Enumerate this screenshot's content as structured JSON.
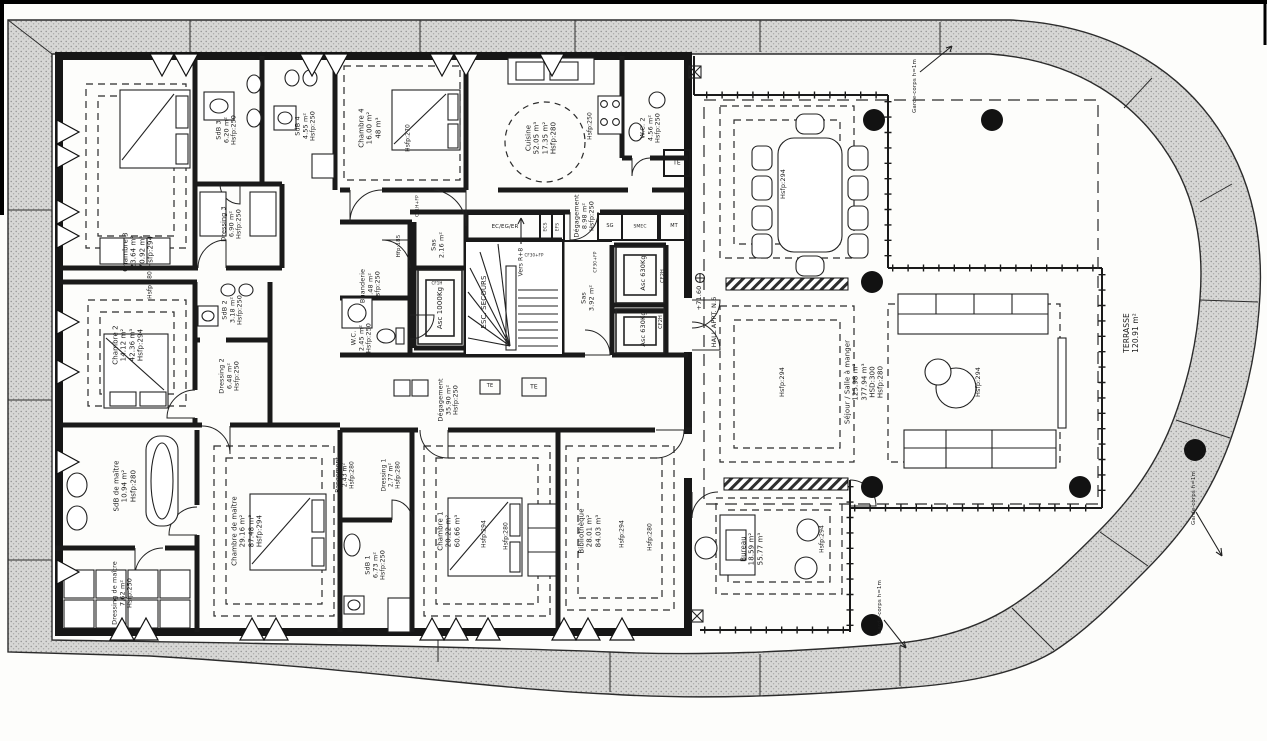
{
  "plan": {
    "apartment": "HALL APPT. N.6",
    "level_marker": "+71.60",
    "terrace": {
      "name": "TERRASSE",
      "area": "120.91 m²"
    },
    "guardrail_note": "Garde-corps h=1m",
    "labels": [
      {
        "name": "room-chambre-3",
        "x": 138,
        "y": 252,
        "size": 7,
        "lines": [
          "Chambre 3",
          "23.64 m²",
          "70.92 m³",
          "Hsfp:294"
        ]
      },
      {
        "name": "room-sdb-3",
        "x": 227,
        "y": 130,
        "size": 6.5,
        "lines": [
          "SdB 3",
          "6.20 m²",
          "Hsfp:250"
        ]
      },
      {
        "name": "room-sdb-4",
        "x": 306,
        "y": 126,
        "size": 6.5,
        "lines": [
          "SdB 4",
          "4.55 m²",
          "Hsfp:250"
        ]
      },
      {
        "name": "room-dressing-3",
        "x": 232,
        "y": 224,
        "size": 6.5,
        "lines": [
          "Dressing 3",
          "6.90 m²",
          "Hsfp:250"
        ]
      },
      {
        "name": "room-chambre-4",
        "x": 370,
        "y": 128,
        "size": 7,
        "lines": [
          "Chambre 4",
          "16.00 m²",
          "48 m³"
        ]
      },
      {
        "name": "height-tag",
        "x": 408,
        "y": 138,
        "size": 6,
        "lines": [
          "Hsfp:270"
        ]
      },
      {
        "name": "height-tag",
        "x": 399,
        "y": 246,
        "size": 5.5,
        "lines": [
          "Hfp:185"
        ]
      },
      {
        "name": "room-cuisine",
        "x": 541,
        "y": 138,
        "size": 7,
        "lines": [
          "Cuisine",
          "52.05 m³",
          "17.35 m²",
          "Hsfp:280"
        ]
      },
      {
        "name": "height-tag",
        "x": 590,
        "y": 126,
        "size": 6,
        "lines": [
          "Hsfp:250"
        ]
      },
      {
        "name": "room-wc-2",
        "x": 651,
        "y": 128,
        "size": 6.5,
        "lines": [
          "W.C. 2",
          "4.56 m²",
          "Hsfp:250"
        ]
      },
      {
        "name": "room-degagement-nord",
        "x": 585,
        "y": 216,
        "size": 6.5,
        "lines": [
          "Dégagement",
          "8.98 m²",
          "Hsfp:250"
        ]
      },
      {
        "name": "room-sas-1",
        "x": 438,
        "y": 245,
        "size": 6.5,
        "lines": [
          "Sas",
          "2.16 m²"
        ]
      },
      {
        "name": "room-buanderie",
        "x": 371,
        "y": 286,
        "size": 6.5,
        "lines": [
          "Buanderie",
          "5.48 m²",
          "Hsfp:250"
        ]
      },
      {
        "name": "room-wc-1",
        "x": 362,
        "y": 338,
        "size": 6.5,
        "lines": [
          "W.C.",
          "2.45 m²",
          "Hsfp:250"
        ]
      },
      {
        "name": "lift-1000",
        "x": 440,
        "y": 308,
        "size": 7,
        "lines": [
          "Asc 1000Kg"
        ]
      },
      {
        "name": "stair-secours",
        "x": 484,
        "y": 302,
        "size": 7,
        "lines": [
          "ESC. SECOURS"
        ]
      },
      {
        "name": "stair-direction",
        "x": 521,
        "y": 262,
        "size": 6,
        "lines": [
          "Vers R+8"
        ]
      },
      {
        "name": "room-sas-2",
        "x": 588,
        "y": 298,
        "size": 6.5,
        "lines": [
          "Sas",
          "3.92 m²"
        ]
      },
      {
        "name": "lift-630-a",
        "x": 644,
        "y": 273,
        "size": 6.5,
        "lines": [
          "Asc 630Kg"
        ]
      },
      {
        "name": "lift-630-b",
        "x": 644,
        "y": 329,
        "size": 6.5,
        "lines": [
          "Asc 630Kg"
        ]
      },
      {
        "name": "fire-tag",
        "x": 664,
        "y": 276,
        "size": 5,
        "lines": [
          "CF2H"
        ]
      },
      {
        "name": "fire-tag",
        "x": 662,
        "y": 322,
        "size": 5,
        "lines": [
          "CF2H"
        ]
      },
      {
        "name": "room-degagement-sud",
        "x": 449,
        "y": 400,
        "size": 6.5,
        "lines": [
          "Dégagement",
          "35.90 m²",
          "Hsfp:250"
        ]
      },
      {
        "name": "height-tag",
        "x": 150,
        "y": 285,
        "size": 6,
        "lines": [
          "Hsfp:280"
        ]
      },
      {
        "name": "room-chambre-2",
        "x": 128,
        "y": 345,
        "size": 7,
        "lines": [
          "Chambre 2",
          "14.12 m²",
          "42.36 m³",
          "Hsfp:294"
        ]
      },
      {
        "name": "room-sdb-2",
        "x": 233,
        "y": 310,
        "size": 6.5,
        "lines": [
          "SdB 2",
          "3.18 m²",
          "Hsfp:250"
        ]
      },
      {
        "name": "room-dressing-2",
        "x": 230,
        "y": 376,
        "size": 6.5,
        "lines": [
          "Dressing 2",
          "6.48 m²",
          "Hsfp:250"
        ]
      },
      {
        "name": "room-sdb-maitre",
        "x": 125,
        "y": 486,
        "size": 7,
        "lines": [
          "SdB de maître",
          "10.94 m²",
          "Hsfp:280"
        ]
      },
      {
        "name": "room-dressing-maitre",
        "x": 123,
        "y": 593,
        "size": 6.5,
        "lines": [
          "Dressing de maître",
          "7.62 m²",
          "Hsfp:250"
        ]
      },
      {
        "name": "room-chambre-maitre",
        "x": 247,
        "y": 531,
        "size": 7,
        "lines": [
          "Chambre de maître",
          "29.16 m²",
          "87.48 m³",
          "Hsfp:294"
        ]
      },
      {
        "name": "room-rangement",
        "x": 345,
        "y": 475,
        "size": 6,
        "lines": [
          "Rangement",
          "2.43 m²",
          "Hsfp:280"
        ]
      },
      {
        "name": "room-dressing-1",
        "x": 391,
        "y": 475,
        "size": 6,
        "lines": [
          "Dressing 1",
          "2.77 m²",
          "Hsfp:280"
        ]
      },
      {
        "name": "room-chambre-1",
        "x": 449,
        "y": 531,
        "size": 7,
        "lines": [
          "Chambre 1",
          "20.22 m²",
          "60.66 m³"
        ]
      },
      {
        "name": "height-tag",
        "x": 484,
        "y": 534,
        "size": 6,
        "lines": [
          "Hsfp:294"
        ]
      },
      {
        "name": "height-tag",
        "x": 506,
        "y": 536,
        "size": 6,
        "lines": [
          "Hsfp:280"
        ]
      },
      {
        "name": "room-sdb-1",
        "x": 376,
        "y": 565,
        "size": 6.5,
        "lines": [
          "SdB 1",
          "6.73 m²",
          "Hsfp:250"
        ]
      },
      {
        "name": "room-bibliotheque",
        "x": 590,
        "y": 531,
        "size": 7,
        "lines": [
          "Bibliothèque",
          "28.01 m²",
          "84.03 m³"
        ]
      },
      {
        "name": "height-tag",
        "x": 622,
        "y": 534,
        "size": 6,
        "lines": [
          "Hsfp:294"
        ]
      },
      {
        "name": "height-tag",
        "x": 650,
        "y": 537,
        "size": 6,
        "lines": [
          "Hsfp:280"
        ]
      },
      {
        "name": "room-bureau",
        "x": 752,
        "y": 549,
        "size": 7,
        "lines": [
          "Bureau",
          "18.59 m²",
          "55.77 m³"
        ]
      },
      {
        "name": "height-tag",
        "x": 822,
        "y": 539,
        "size": 6,
        "lines": [
          "Hsfp:294"
        ]
      },
      {
        "name": "room-sejour",
        "x": 864,
        "y": 382,
        "size": 7,
        "lines": [
          "Séjour / Salle à manger",
          "125.98 m²",
          "377.94 m³",
          "HSD:300",
          "Hsfp:280"
        ]
      },
      {
        "name": "height-tag",
        "x": 784,
        "y": 184,
        "size": 6.5,
        "lines": [
          "Hsfp:294"
        ]
      },
      {
        "name": "height-tag",
        "x": 783,
        "y": 382,
        "size": 6.5,
        "lines": [
          "Hsfp:294"
        ]
      },
      {
        "name": "height-tag",
        "x": 979,
        "y": 382,
        "size": 6.5,
        "lines": [
          "Hsfp:294"
        ]
      },
      {
        "name": "level-marker",
        "x": 700,
        "y": 298,
        "size": 6.5,
        "lines": [
          "+71.60"
        ]
      },
      {
        "name": "hall-label",
        "x": 715,
        "y": 322,
        "size": 6.5,
        "lines": [
          "HALL APPT. N.6"
        ]
      },
      {
        "name": "room-terrasse",
        "x": 1132,
        "y": 333,
        "size": 7.5,
        "lines": [
          "TERRASSE",
          "120.91 m²"
        ]
      },
      {
        "name": "guardrail-note",
        "x": 915,
        "y": 86,
        "size": 5.5,
        "lines": [
          "Garde-corps h=1m"
        ]
      },
      {
        "name": "guardrail-note",
        "x": 1194,
        "y": 498,
        "size": 5.5,
        "lines": [
          "Garde-corps h=1m"
        ]
      },
      {
        "name": "guardrail-note",
        "x": 880,
        "y": 607,
        "size": 5.5,
        "lines": [
          "Garde-corps h=1m"
        ]
      },
      {
        "name": "shaft-label",
        "x": 505,
        "y": 227,
        "rot": 0,
        "size": 5.5,
        "lines": [
          "EC/EG/ER"
        ]
      },
      {
        "name": "shaft-label",
        "x": 546,
        "y": 227,
        "size": 4.5,
        "lines": [
          "ECS"
        ]
      },
      {
        "name": "shaft-label",
        "x": 558,
        "y": 227,
        "size": 4.5,
        "lines": [
          "EFS"
        ]
      },
      {
        "name": "shaft-label",
        "x": 610,
        "y": 227,
        "rot": 0,
        "size": 5,
        "lines": [
          "SG"
        ]
      },
      {
        "name": "shaft-label",
        "x": 640,
        "y": 227,
        "rot": 0,
        "size": 4.5,
        "lines": [
          "SMEC"
        ]
      },
      {
        "name": "shaft-label",
        "x": 674,
        "y": 227,
        "rot": 0,
        "size": 5,
        "lines": [
          "MT"
        ]
      },
      {
        "name": "shaft-label",
        "x": 677,
        "y": 163,
        "rot": 0,
        "size": 6,
        "lines": [
          "TE"
        ]
      },
      {
        "name": "shaft-label",
        "x": 534,
        "y": 387,
        "rot": 0,
        "size": 6,
        "lines": [
          "TE"
        ]
      },
      {
        "name": "shaft-label",
        "x": 490,
        "y": 387,
        "rot": 0,
        "size": 5,
        "lines": [
          "TE"
        ]
      },
      {
        "name": "fire-tag",
        "x": 418,
        "y": 206,
        "size": 4.5,
        "lines": [
          "CF1H+FP"
        ]
      },
      {
        "name": "fire-tag",
        "x": 596,
        "y": 262,
        "size": 4.5,
        "lines": [
          "CF30+FP"
        ]
      },
      {
        "name": "fire-tag",
        "x": 534,
        "y": 256,
        "rot": 0,
        "size": 4,
        "lines": [
          "CF30+FP"
        ]
      },
      {
        "name": "fire-tag",
        "x": 437,
        "y": 284,
        "rot": 0,
        "size": 4,
        "lines": [
          "CF1H"
        ]
      }
    ]
  }
}
